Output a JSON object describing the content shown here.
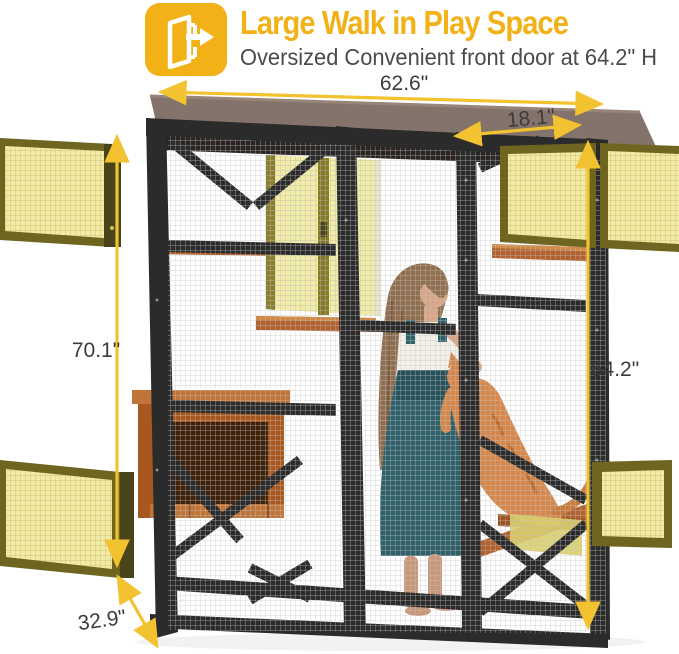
{
  "header": {
    "icon": "walk-in-door-icon",
    "title": "Large Walk in Play Space",
    "subtitle": "Oversized Convenient front door at 64.2\" H"
  },
  "dimensions": {
    "top_width": "62.6\"",
    "front_door_width": "18.1\"",
    "left_height": "70.1\"",
    "front_door_height": "64.2\"",
    "depth": "32.9\""
  },
  "colors": {
    "accent_yellow": "#F1B117",
    "subtitle_gray": "#4A4A4A",
    "dimension_label_gray": "#3C3C3C",
    "arrow_yellow": "#F2C230",
    "roof_taupe": "#84736B",
    "frame_charcoal": "#2B2B2B",
    "wood_orange": "#B2622E",
    "open_door_mesh": "#F1EBA7",
    "open_door_frame_olive": "#6E6620",
    "girl_dress_teal": "#30606A",
    "cat_orange": "#D6884C"
  },
  "scene": {
    "subject": "cat-enclosure-catio-with-girl-petting-cat",
    "highlighted_open_doors": 5
  }
}
